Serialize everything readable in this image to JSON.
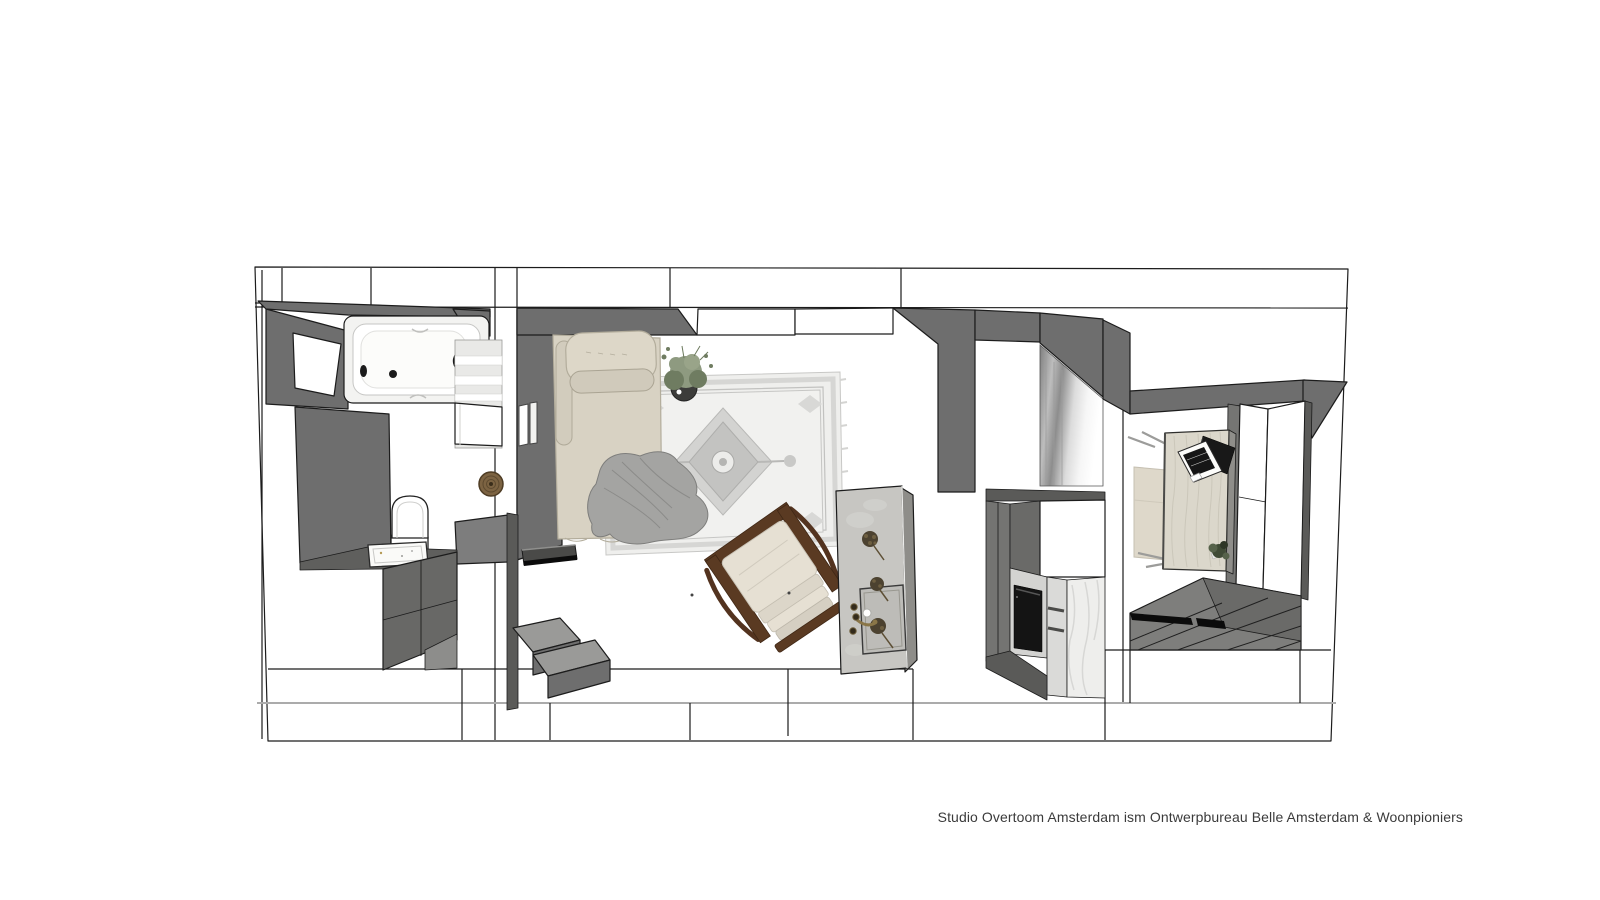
{
  "caption": {
    "text": "Studio Overtoom Amsterdam ism Ontwerpbureau Belle Amsterdam & Woonpioniers"
  },
  "colors": {
    "caption": "#3b3b3b",
    "outline": "#1c1c1c",
    "band_line": "#ababab",
    "wall_dark": "#6e6e6e",
    "wall_mid": "#7d7d7d",
    "wall_deep": "#5a5a58",
    "wall_light": "#9a9a98",
    "bed": "#d8d2c3",
    "pillow": "#ddd7c8",
    "blanket": "#a4a4a2",
    "rug_base": "#efefed",
    "rug_border": "#d6d6d4",
    "rug_medallion": "#d3d3d1",
    "wood": "#5a3a22",
    "cushion": "#e6e0d3",
    "island_top": "#c7c6c2",
    "island_side": "#8e8d89",
    "brass": "#8a7648",
    "oven": "#141414",
    "marble": "#eeeeec",
    "desk": "#dbd7cb",
    "desk_side": "#8f8e8a",
    "laptop": "#181818",
    "plank": "#7e7e7c",
    "plank_dark": "#6a6a68",
    "mat": "#0b0b0b",
    "plant": "#8e9a80",
    "plant_dark": "#6f7c61",
    "pot": "#3c3c3a",
    "rattan": "#7c6342",
    "curtain_gray": "#858585"
  },
  "plan": {
    "view": "top-down 3d floor plan",
    "rooms": [
      {
        "name": "bathroom",
        "items": [
          "window",
          "bathtub",
          "bath-faucet",
          "toilet",
          "sink-vanity",
          "vanity-cabinets",
          "shelving",
          "rattan-mirror"
        ]
      },
      {
        "name": "living-room",
        "items": [
          "daybed",
          "bolster-pillows",
          "blanket",
          "potted-plant",
          "persian-rug",
          "rocking-chair",
          "wall-frames",
          "wall-shelf",
          "steps"
        ]
      },
      {
        "name": "kitchen",
        "items": [
          "kitchen-island",
          "island-sink",
          "island-faucet",
          "dried-bouquets",
          "tall-cabinets",
          "oven",
          "marble-panel",
          "curtain"
        ]
      },
      {
        "name": "study-entry",
        "items": [
          "desk",
          "laptop",
          "desk-chair",
          "desk-plant",
          "wardrobe",
          "plank-floor",
          "door-mats"
        ]
      }
    ]
  }
}
